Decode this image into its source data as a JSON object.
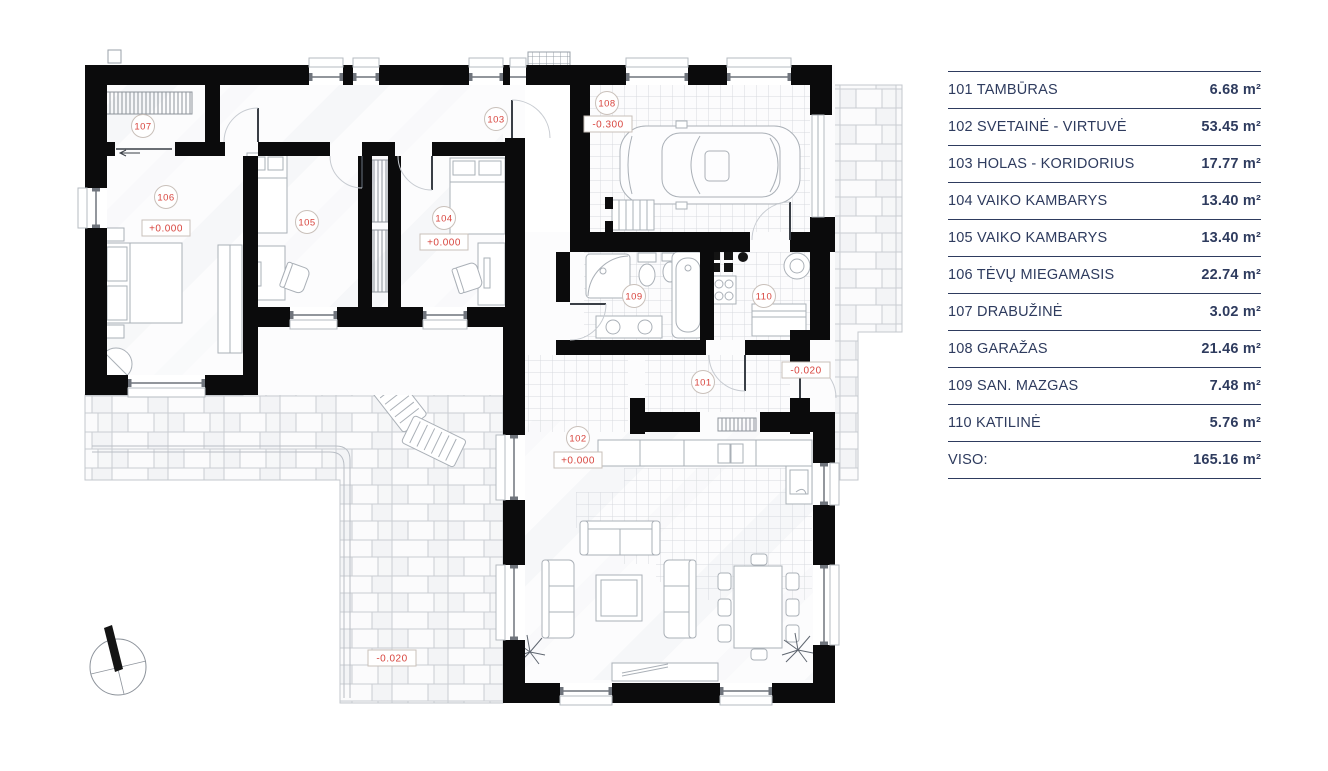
{
  "legend": {
    "rows": [
      {
        "label": "101 TAMBŪRAS",
        "area": "6.68 m²"
      },
      {
        "label": "102 SVETAINĖ - VIRTUVĖ",
        "area": "53.45 m²"
      },
      {
        "label": "103 HOLAS - KORIDORIUS",
        "area": "17.77 m²"
      },
      {
        "label": "104 VAIKO KAMBARYS",
        "area": "13.40 m²"
      },
      {
        "label": "105 VAIKO KAMBARYS",
        "area": "13.40 m²"
      },
      {
        "label": "106 TĖVŲ MIEGAMASIS",
        "area": "22.74 m²"
      },
      {
        "label": "107 DRABUŽINĖ",
        "area": "3.02 m²"
      },
      {
        "label": "108 GARAŽAS",
        "area": "21.46 m²"
      },
      {
        "label": "109 SAN. MAZGAS",
        "area": "7.48 m²"
      },
      {
        "label": "110 KATILINĖ",
        "area": "5.76 m²"
      },
      {
        "label": "VISO:",
        "area": "165.16 m²"
      }
    ]
  },
  "plan": {
    "room_markers": [
      {
        "number": "107",
        "x": 143,
        "y": 126
      },
      {
        "number": "106",
        "x": 166,
        "y": 197
      },
      {
        "number": "105",
        "x": 307,
        "y": 222
      },
      {
        "number": "104",
        "x": 444,
        "y": 218
      },
      {
        "number": "103",
        "x": 496,
        "y": 119
      },
      {
        "number": "108",
        "x": 607,
        "y": 103
      },
      {
        "number": "109",
        "x": 634,
        "y": 296
      },
      {
        "number": "110",
        "x": 764,
        "y": 296
      },
      {
        "number": "101",
        "x": 703,
        "y": 382
      },
      {
        "number": "102",
        "x": 578,
        "y": 438
      }
    ],
    "elevation_markers": [
      {
        "text": "+0.000",
        "x": 166,
        "y": 228
      },
      {
        "text": "+0.000",
        "x": 444,
        "y": 242
      },
      {
        "text": "-0.300",
        "x": 608,
        "y": 124
      },
      {
        "text": "+0.000",
        "x": 578,
        "y": 460
      },
      {
        "text": "-0.020",
        "x": 806,
        "y": 370
      },
      {
        "text": "-0.020",
        "x": 392,
        "y": 658
      }
    ],
    "colors": {
      "marker_red": "#d8453e",
      "marker_border": "#c9c0ba",
      "wall": "#0b0b0c",
      "legend_navy": "#2e3b5e"
    }
  }
}
